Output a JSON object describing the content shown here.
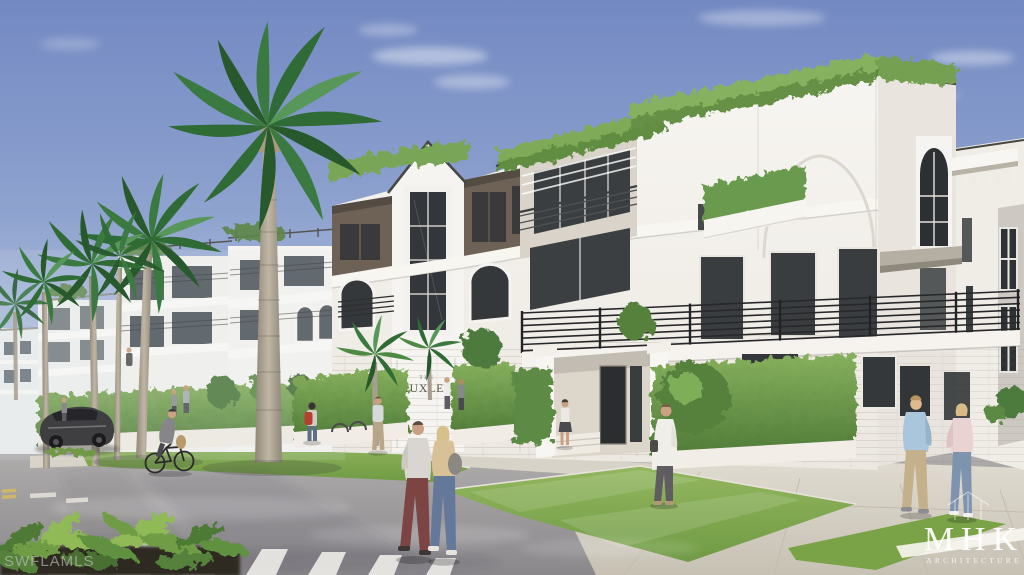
{
  "scene": {
    "description": "Architectural street rendering of a three-story white luxury condominium with rooftop hedges, palms, pedestrians and a parked car",
    "signage": {
      "prefix": "THE",
      "name": "HUXLEY"
    },
    "watermarks": {
      "mls": "SWFLAMLS",
      "architect_logo": "MHK",
      "architect_logo_sub": "ARCHITECTURE"
    },
    "palette": {
      "sky_top": "#7389c2",
      "sky_horizon": "#dde4ee",
      "building_white": "#f5f3ef",
      "bronze_panel": "#6e6257",
      "glazing": "#35383b",
      "hedge_green": "#6f9c4c",
      "lawn_green": "#84ab54",
      "street_asphalt": "#9a969a",
      "sidewalk": "#d9d4c9",
      "railing_black": "#2e2e30"
    },
    "people": [
      {
        "label": "cyclist-gray-jacket"
      },
      {
        "label": "pedestrian-red-backpack"
      },
      {
        "label": "man-khaki-pants"
      },
      {
        "label": "crossing-man-maroon-pants"
      },
      {
        "label": "crossing-woman-tan-top"
      },
      {
        "label": "woman-entrance-steps"
      },
      {
        "label": "man-white-shirt-phone"
      },
      {
        "label": "man-blue-shirt"
      },
      {
        "label": "woman-pink-top"
      }
    ],
    "objects": [
      {
        "label": "parked-sports-car"
      },
      {
        "label": "royal-palm-tall"
      },
      {
        "label": "rooftop-hedge"
      },
      {
        "label": "street-crosswalk"
      },
      {
        "label": "foreground-plants"
      }
    ]
  }
}
